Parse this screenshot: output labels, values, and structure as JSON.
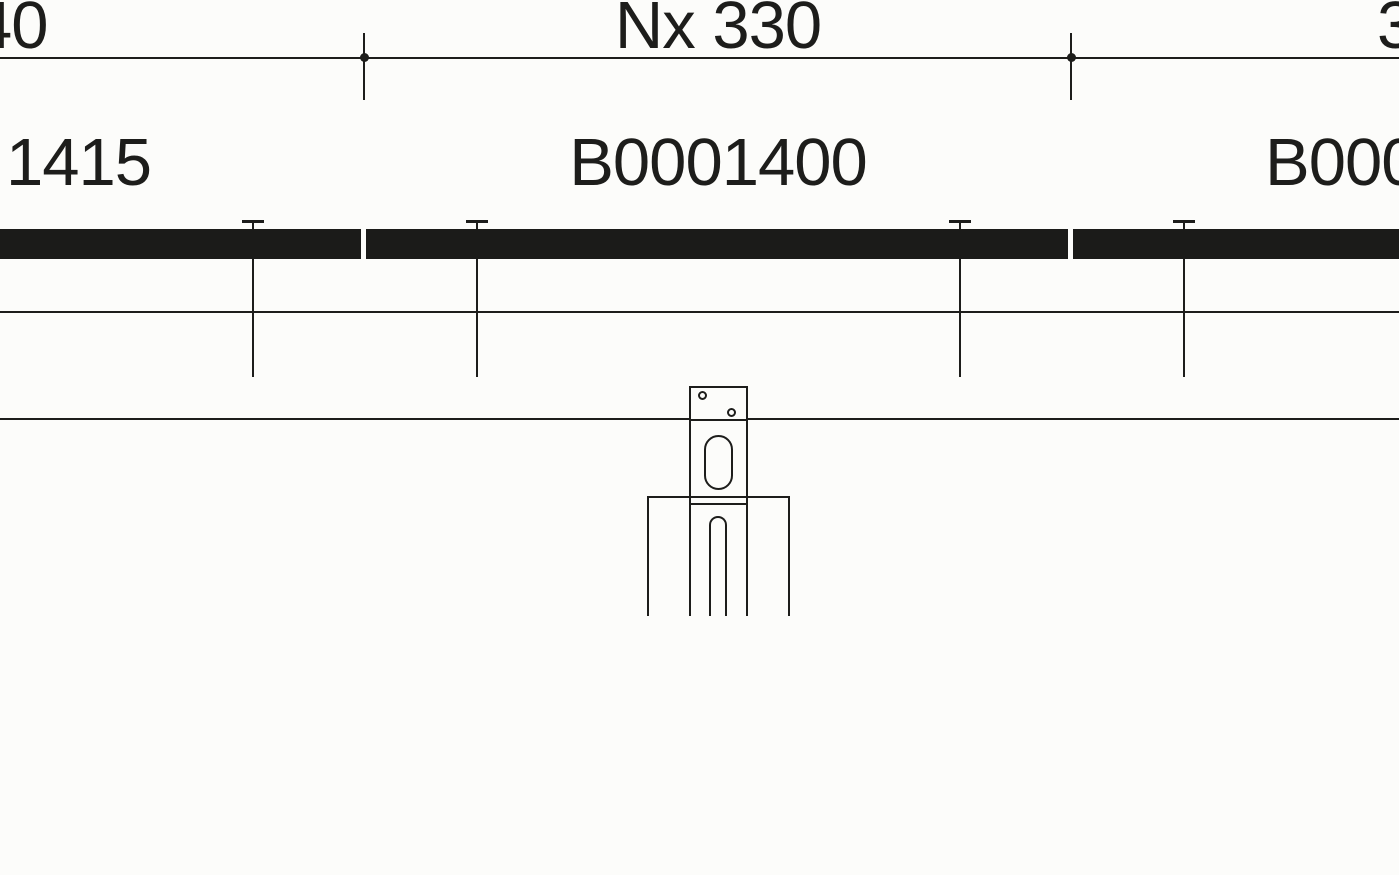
{
  "canvas": {
    "background": "#fcfcfa",
    "line_color": "#1d1d1b",
    "rail_color": "#1b1b19"
  },
  "dimension_row": {
    "label_left": "40",
    "label_center": "Nx 330",
    "label_right": "3"
  },
  "part_labels": {
    "left": "1415",
    "center": "B0001400",
    "right": "B000"
  }
}
